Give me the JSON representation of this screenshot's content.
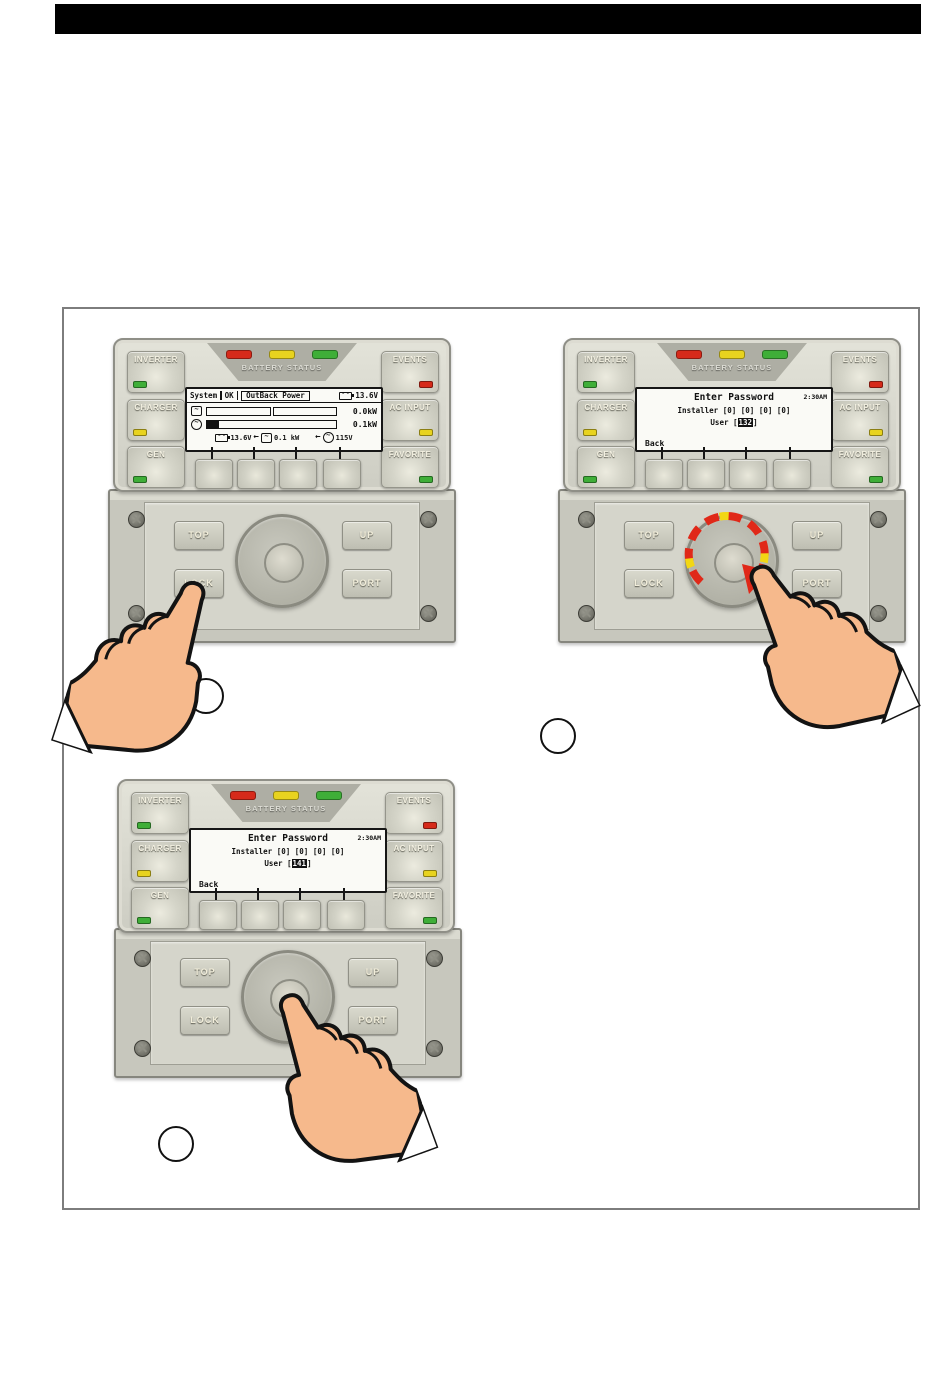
{
  "labels": {
    "inverter": "INVERTER",
    "charger": "CHARGER",
    "gen": "GEN",
    "events": "EVENTS",
    "ac_input": "AC INPUT",
    "favorite": "FAVORITE",
    "battery_status": "BATTERY STATUS",
    "top": "TOP",
    "lock": "LOCK",
    "up": "UP",
    "port": "PORT"
  },
  "screen1": {
    "menu": "System",
    "status": "OK",
    "title": "OutBack Power",
    "battery_voltage": "13.6V",
    "inverter_power": "0.0kW",
    "ac_power": "0.1kW",
    "footer_battery_voltage": "13.6V",
    "footer_arrow": "←",
    "footer_inverter_power": "0.1 kW",
    "footer_ac_voltage": "115V"
  },
  "screen2": {
    "title": "Enter Password",
    "time": "2:30AM",
    "installer_label": "Installer",
    "installer_digits": "[0] [0] [0] [0]",
    "user_label": "User",
    "bracket_open": "[",
    "user_value": "132",
    "bracket_close": "]",
    "back_label": "Back"
  },
  "screen3": {
    "title": "Enter Password",
    "time": "2:30AM",
    "installer_label": "Installer",
    "installer_digits": "[0] [0] [0] [0]",
    "user_label": "User",
    "bracket_open": "[",
    "user_value": "141",
    "bracket_close": "]",
    "back_label": "Back"
  },
  "steps": [
    "",
    "",
    ""
  ],
  "icons": [
    "battery-icon",
    "inverter-icon",
    "ac-icon",
    "screw-icon",
    "rotate-clockwise-arrow",
    "pointing-hand-icon",
    "step-marker"
  ],
  "colors": {
    "led_red": "#d62a1a",
    "led_yellow": "#e8d31f",
    "led_green": "#3fae38",
    "device_body": "#d6d6cb",
    "rotation_red": "#e02818",
    "rotation_yellow": "#f2d714",
    "hand_skin": "#f6b98c"
  }
}
